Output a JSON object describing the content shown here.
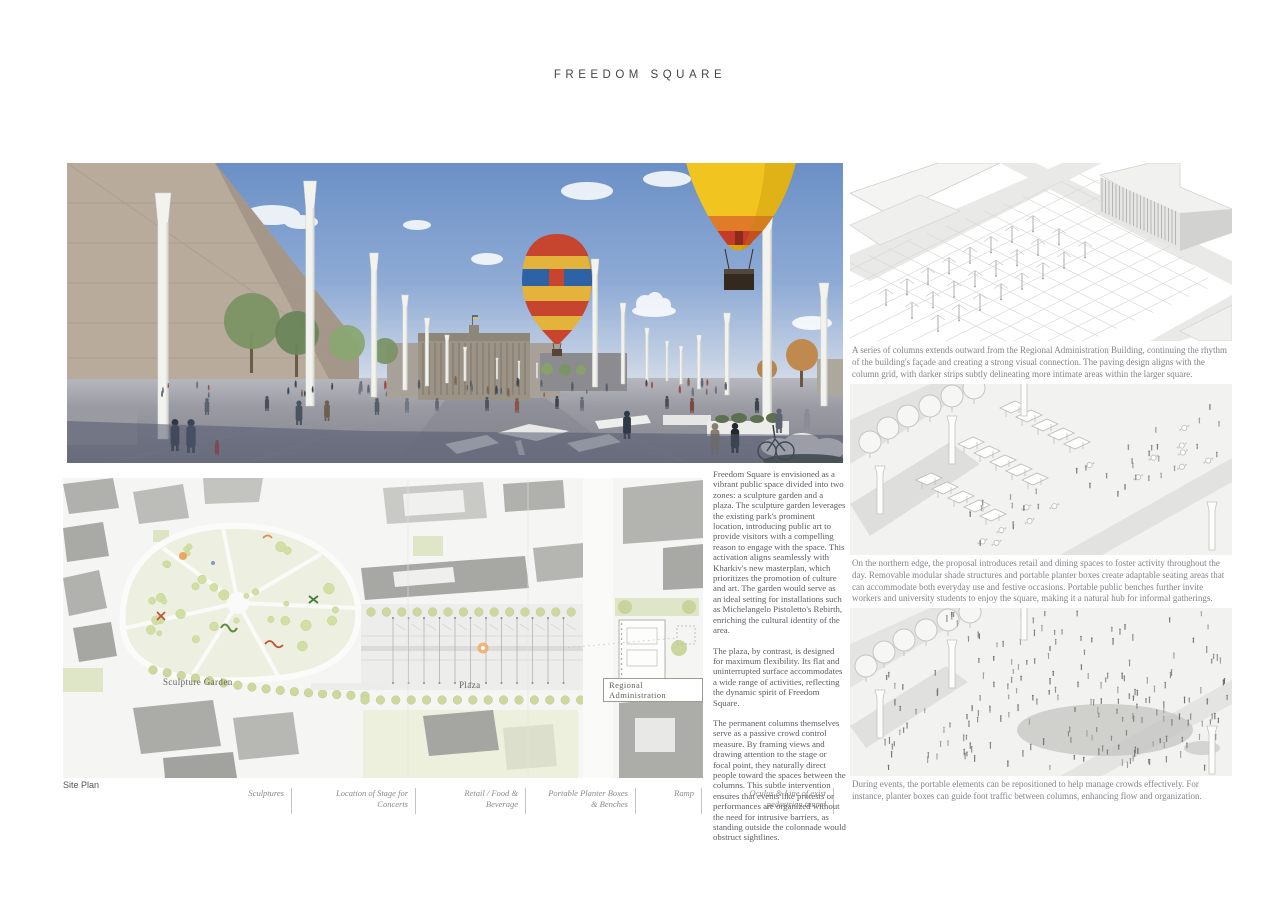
{
  "title": "FREEDOM SQUARE",
  "site_plan": {
    "label": "Site Plan",
    "zones": {
      "sculpture_garden": "Sculpture Garden",
      "plaza": "Plaza",
      "regional_administration": "Regional Administration"
    },
    "legend": [
      "Sculptures",
      "Location of Stage for Concerts",
      "Retail / Food & Beverage",
      "Portable Planter Boxes & Benches",
      "Ramp",
      "Oculus & Line of exist pedestrian tunnel"
    ]
  },
  "description": {
    "paragraphs": [
      "Freedom Square is envisioned as a vibrant public space divided into two zones: a sculpture garden and a plaza. The sculpture garden leverages the existing park's prominent location, introducing public art to provide visitors with a compelling reason to engage with the space. This activation aligns seamlessly with Kharkiv's new masterplan, which prioritizes the promotion of culture and art. The garden would serve as an ideal setting for installations such as Michelangelo Pistoletto's Rebirth, enriching the cultural identity of the area.",
      "The plaza, by contrast, is designed for maximum flexibility. Its flat and uninterrupted surface accommodates a wide range of activities, reflecting the dynamic spirit of Freedom Square.",
      "The permanent columns themselves serve as a passive crowd control measure. By framing views and drawing attention to the stage or focal point, they naturally direct people toward the spaces between the columns. This subtle intervention ensures that events like protests or performances are organized without the need for intrusive barriers, as standing outside the colonnade would obstruct sightlines."
    ]
  },
  "axonometrics": [
    {
      "caption": "A series of columns extends outward from the Regional Administration Building, continuing the rhythm of the building's façade and creating a strong visual connection. The paving design aligns with the column grid, with darker strips subtly delineating more intimate areas within the larger square."
    },
    {
      "caption": "On the northern edge, the proposal introduces retail and dining spaces to foster activity throughout the day. Removable modular shade structures and portable planter boxes create adaptable seating areas that can accommodate both everyday use and festive occasions. Portable public benches further invite workers and university students to enjoy the square, making it a natural hub for informal gatherings."
    },
    {
      "caption": "During events, the portable elements can be repositioned to help manage crowds effectively. For instance, planter boxes can guide foot traffic between columns, enhancing flow and organization."
    }
  ],
  "colors": {
    "sky_blue": "#6b90c6",
    "pavement_gray": "#8e8e96",
    "foreground_shadow": "#525a70",
    "building_beige": "#b8ab9b",
    "balloon_yellow": "#f2c41f",
    "balloon_red": "#c7452f",
    "balloon_blue": "#2d62a6",
    "park_green": "#edf0e0",
    "tree_green": "#d2dfa4",
    "stage_orange": "#f0ab66",
    "text_dark": "#45454b",
    "text_body": "#5d5d63",
    "text_caption": "#84848a"
  }
}
